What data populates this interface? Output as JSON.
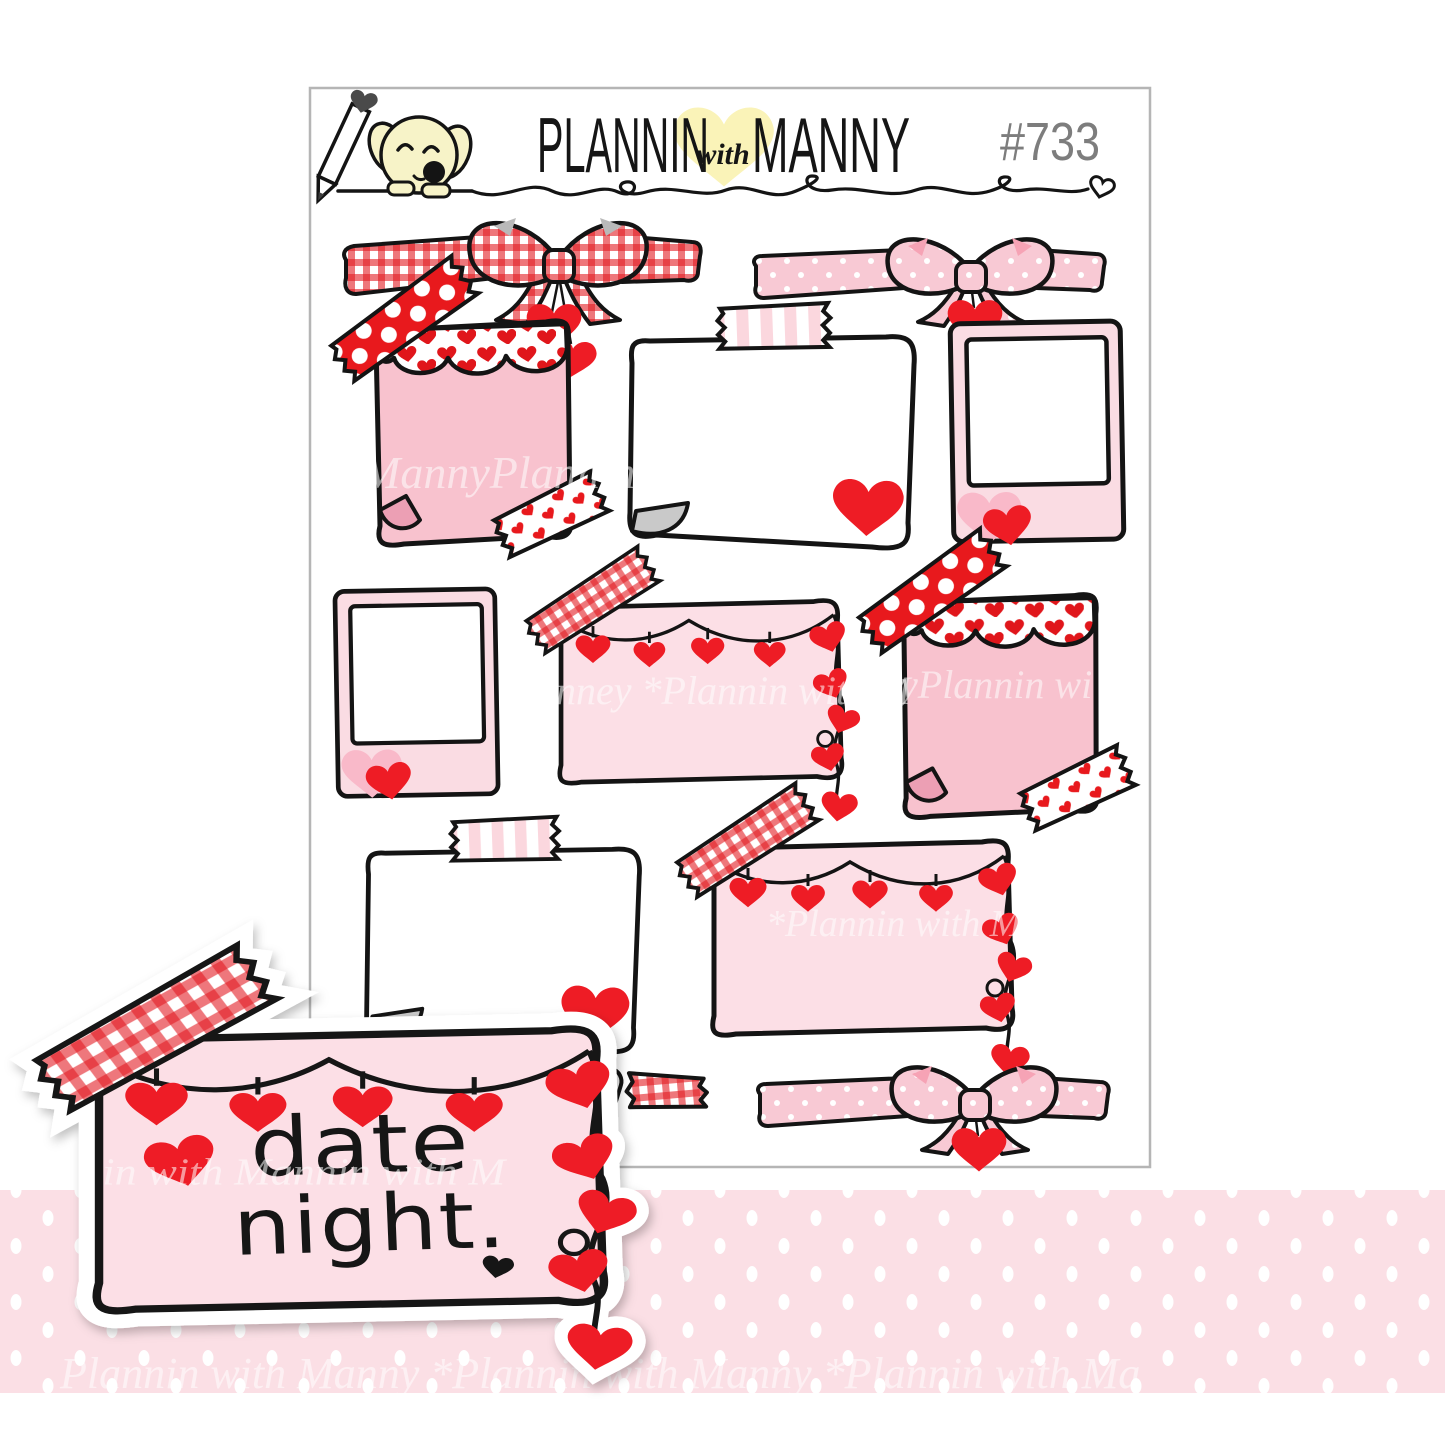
{
  "header": {
    "brand_first": "PLANNIN",
    "brand_with": "with",
    "brand_last": "MANNY",
    "sheet_number": "#733",
    "mascot": "manny-dog-with-pencil"
  },
  "sample": {
    "line1": "date",
    "line2": "night."
  },
  "watermark": {
    "fragments": [
      "MannyPlannin",
      "nney *Plannin with M",
      "yPlannin wi",
      "*Plannin with M",
      "in with Mannin with M",
      "Plannin with Manny *Plannin with Manny *Plannin with Ma"
    ]
  },
  "stickers": [
    "red-gingham-bow-ribbon",
    "pink-polka-dot-bow-ribbon",
    "scalloped-heart-pink-note",
    "taped-white-note",
    "pink-polaroid-frame",
    "polaroid-frame",
    "heart-garland-box",
    "scalloped-heart-pink-note",
    "taped-white-note",
    "heart-garland-box",
    "gingham-washi-roll",
    "pink-polka-dot-bow-ribbon"
  ],
  "colors": {
    "red": "#e8191d",
    "heart_red": "#ee1c25",
    "outline": "#141414",
    "note_pink": "#f8c2ce",
    "curl_pink": "#ec9fb4",
    "box_pink": "#fcdfe6",
    "polaroid_pink": "#fadce3",
    "stripe_pink": "#fbd7de",
    "bow_pink": "#f8c9d4",
    "band_pink": "#fbdfe5",
    "mascot_yellow": "#f7f3c8",
    "logo_heart_yellow": "#faf3b8",
    "page_curl_gray": "#c9c9c9",
    "number_gray": "#7d7d7d",
    "sheet_border": "#b5b5b5"
  }
}
